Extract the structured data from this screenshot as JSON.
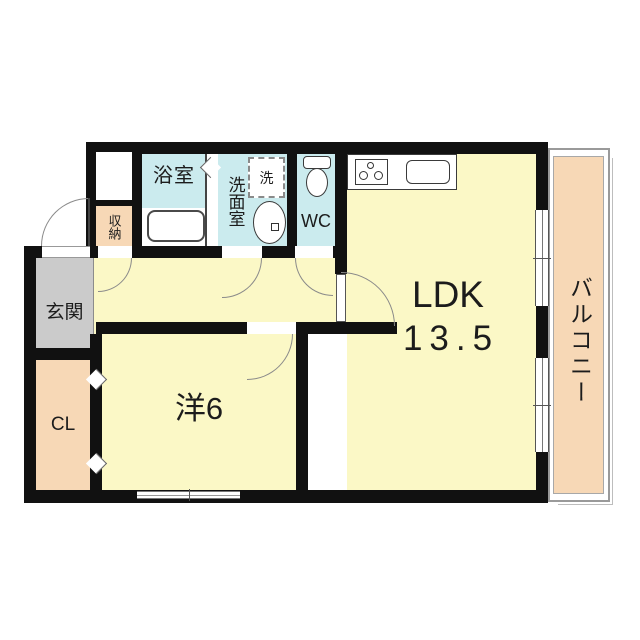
{
  "floorplan": {
    "type": "apartment-floor-plan",
    "rooms": {
      "ldk": {
        "label": "LDK",
        "area": "13.5"
      },
      "western_room": {
        "label": "洋6"
      },
      "balcony": {
        "label": "バルコニー"
      },
      "entrance": {
        "label": "玄関"
      },
      "closet": {
        "label": "CL"
      },
      "storage": {
        "label": "収納"
      },
      "bathroom": {
        "label": "浴室"
      },
      "washroom": {
        "label": "洗面室"
      },
      "washing_machine": {
        "label": "洗"
      },
      "toilet": {
        "label": "WC"
      }
    },
    "colors": {
      "room_fill": "#FBF8C6",
      "wet_area_fill": "#CBEBEE",
      "balcony_fill": "#F7D8B6",
      "entrance_fill": "#CBCBCB",
      "wall": "#111111",
      "arc_line": "#8A8A8A"
    }
  }
}
